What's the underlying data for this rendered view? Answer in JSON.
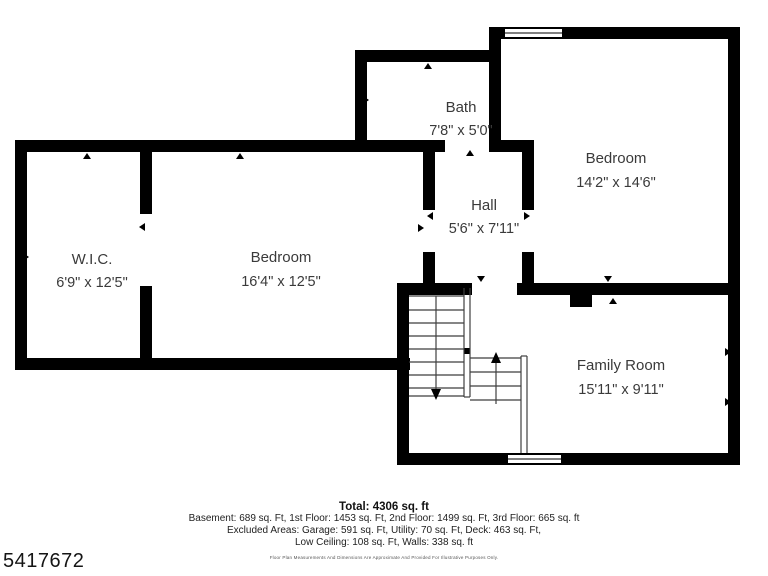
{
  "watermark": "5417672",
  "rooms": [
    {
      "name": "Bath",
      "dims": "7'8\" x 5'0\""
    },
    {
      "name": "Bedroom",
      "dims": "14'2\" x 14'6\""
    },
    {
      "name": "Hall",
      "dims": "5'6\" x 7'11\""
    },
    {
      "name": "W.I.C.",
      "dims": "6'9\" x 12'5\""
    },
    {
      "name": "Bedroom",
      "dims": "16'4\" x 12'5\""
    },
    {
      "name": "Family Room",
      "dims": "15'11\" x 9'11\""
    }
  ],
  "summary": {
    "total": "Total: 4306 sq. ft",
    "line1": "Basement: 689 sq. Ft, 1st Floor: 1453 sq. Ft, 2nd Floor: 1499 sq. Ft, 3rd Floor: 665 sq. ft",
    "line2": "Excluded Areas: Garage: 591 sq. Ft, Utility: 70 sq. Ft, Deck: 463 sq. Ft,",
    "line3": "Low Ceiling: 108 sq. Ft, Walls: 338 sq. ft",
    "disclaimer": "Floor Plan Measurements And Dimensions Are Approximate And Provided For Illustrative Purposes Only."
  },
  "colors": {
    "wall": "#000000",
    "label": "#3a3a3a",
    "stair_line": "#3f3f3f"
  }
}
